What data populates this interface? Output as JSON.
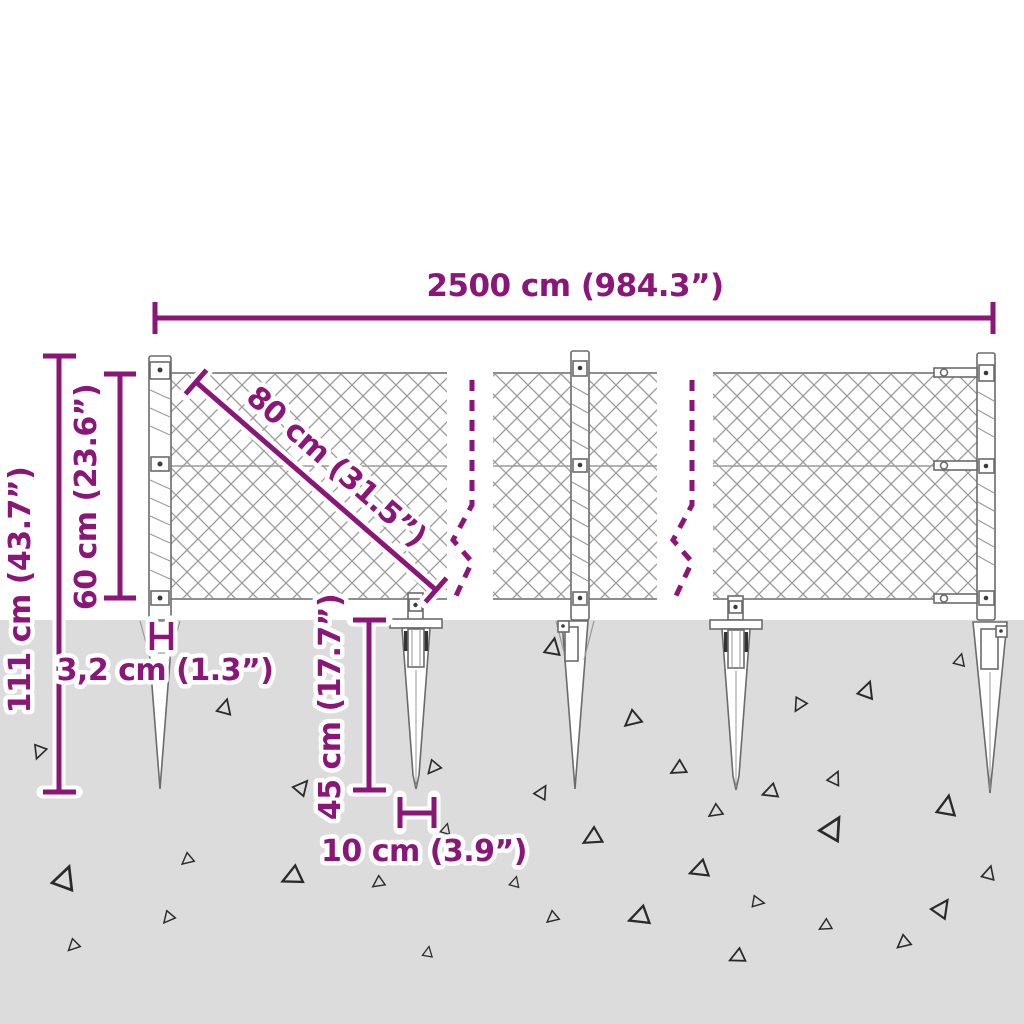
{
  "diagram": {
    "type": "product-dimension-diagram",
    "subject": "chain-link fence with ground spikes"
  },
  "dimensions": {
    "total_width": "2500 cm (984.3”)",
    "total_height": "111 cm (43.7”)",
    "mesh_height": "60 cm (23.6”)",
    "mesh_diagonal": "80 cm (31.5”)",
    "post_width": "3,2 cm (1.3”)",
    "spike_length": "45 cm (17.7”)",
    "spike_spacing": "10 cm (3.9”)"
  },
  "colors": {
    "dimension_accent": "#8a1678",
    "ground": "#dcdcdd",
    "mesh": "#9c9c9c",
    "hardware_outline": "#6b6b6b",
    "debris": "#2a2a2a",
    "background": "#ffffff"
  },
  "debris_triangles": [
    [
      39,
      752,
      0.9,
      200
    ],
    [
      225,
      707,
      1.0,
      15
    ],
    [
      302,
      787,
      1.0,
      40
    ],
    [
      433,
      768,
      0.9,
      220
    ],
    [
      446,
      829,
      0.7,
      15
    ],
    [
      553,
      647,
      1.1,
      10
    ],
    [
      632,
      720,
      1.1,
      230
    ],
    [
      678,
      769,
      1.0,
      240
    ],
    [
      542,
      792,
      0.9,
      30
    ],
    [
      770,
      792,
      1.0,
      250
    ],
    [
      715,
      812,
      0.9,
      235
    ],
    [
      592,
      838,
      1.2,
      240
    ],
    [
      867,
      690,
      1.1,
      20
    ],
    [
      799,
      705,
      0.9,
      210
    ],
    [
      960,
      660,
      0.8,
      15
    ],
    [
      835,
      778,
      0.9,
      25
    ],
    [
      947,
      806,
      1.3,
      10
    ],
    [
      833,
      828,
      1.5,
      30
    ],
    [
      989,
      873,
      0.9,
      15
    ],
    [
      65,
      878,
      1.5,
      20
    ],
    [
      187,
      860,
      0.8,
      230
    ],
    [
      292,
      877,
      1.3,
      245
    ],
    [
      168,
      918,
      0.8,
      220
    ],
    [
      73,
      946,
      0.8,
      225
    ],
    [
      378,
      883,
      0.8,
      235
    ],
    [
      428,
      952,
      0.7,
      10
    ],
    [
      515,
      882,
      0.7,
      15
    ],
    [
      699,
      870,
      1.2,
      250
    ],
    [
      758,
      902,
      0.8,
      100
    ],
    [
      552,
      918,
      0.8,
      230
    ],
    [
      639,
      917,
      1.3,
      250
    ],
    [
      825,
      926,
      0.8,
      240
    ],
    [
      942,
      908,
      1.2,
      35
    ],
    [
      903,
      943,
      0.9,
      230
    ],
    [
      737,
      957,
      1.0,
      245
    ]
  ]
}
